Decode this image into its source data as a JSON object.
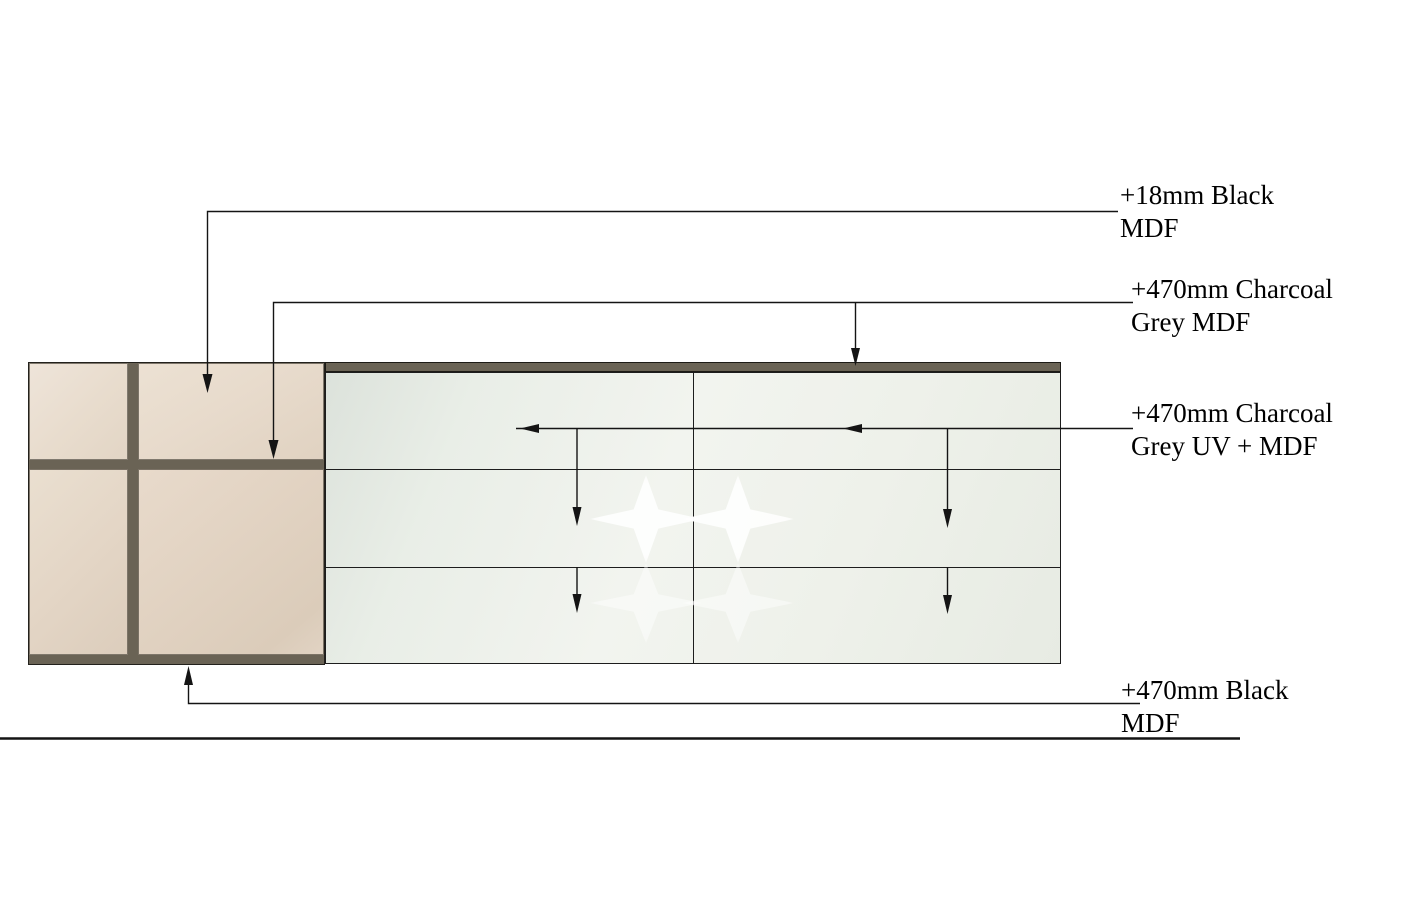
{
  "colors": {
    "page-bg": "#ffffff",
    "frame-dark": "#6a6355",
    "beige-panel": "#e8dccd",
    "glass-light": "#f2f4ef",
    "glass-dark": "#dce2db",
    "line": "#141414",
    "text": "#000000"
  },
  "annotations": [
    {
      "line1": "+18mm Black",
      "line2": "MDF"
    },
    {
      "line1": "+470mm Charcoal",
      "line2": "Grey MDF"
    },
    {
      "line1": "+470mm Charcoal",
      "line2": "Grey UV + MDF"
    },
    {
      "line1": "+470mm Black",
      "line2": "MDF"
    }
  ]
}
